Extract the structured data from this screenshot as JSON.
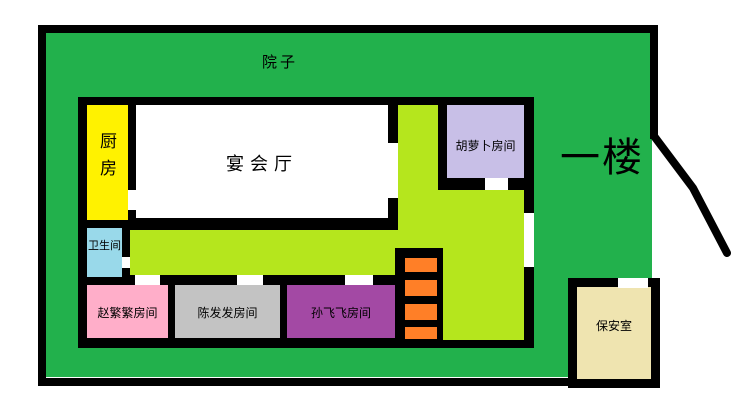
{
  "diagram": {
    "type": "floor-plan",
    "floor_label": "一楼",
    "courtyard_label": "院子"
  },
  "rooms": [
    {
      "id": "kitchen",
      "label": "厨房",
      "color": "#FFF200"
    },
    {
      "id": "banquet-hall",
      "label": "宴会厅",
      "color": "#FFFFFF"
    },
    {
      "id": "carrot-room",
      "label": "胡萝卜房间",
      "color": "#C8BFE7"
    },
    {
      "id": "bathroom",
      "label": "卫生间",
      "color": "#99D9EA"
    },
    {
      "id": "zhao-fanfan-room",
      "label": "赵繁繁房间",
      "color": "#FFAEC9"
    },
    {
      "id": "chen-fafa-room",
      "label": "陈发发房间",
      "color": "#C3C3C3"
    },
    {
      "id": "sun-feifei-room",
      "label": "孙飞飞房间",
      "color": "#A349A4"
    },
    {
      "id": "security-room",
      "label": "保安室",
      "color": "#EFE4B0"
    }
  ],
  "corridor": {
    "color": "#B5E61D"
  },
  "stairs": {
    "steps": 4,
    "color": "#FF7F27"
  },
  "colors": {
    "courtyard": "#22B14C",
    "walls": "#000000",
    "background": "#FFFFFF"
  }
}
